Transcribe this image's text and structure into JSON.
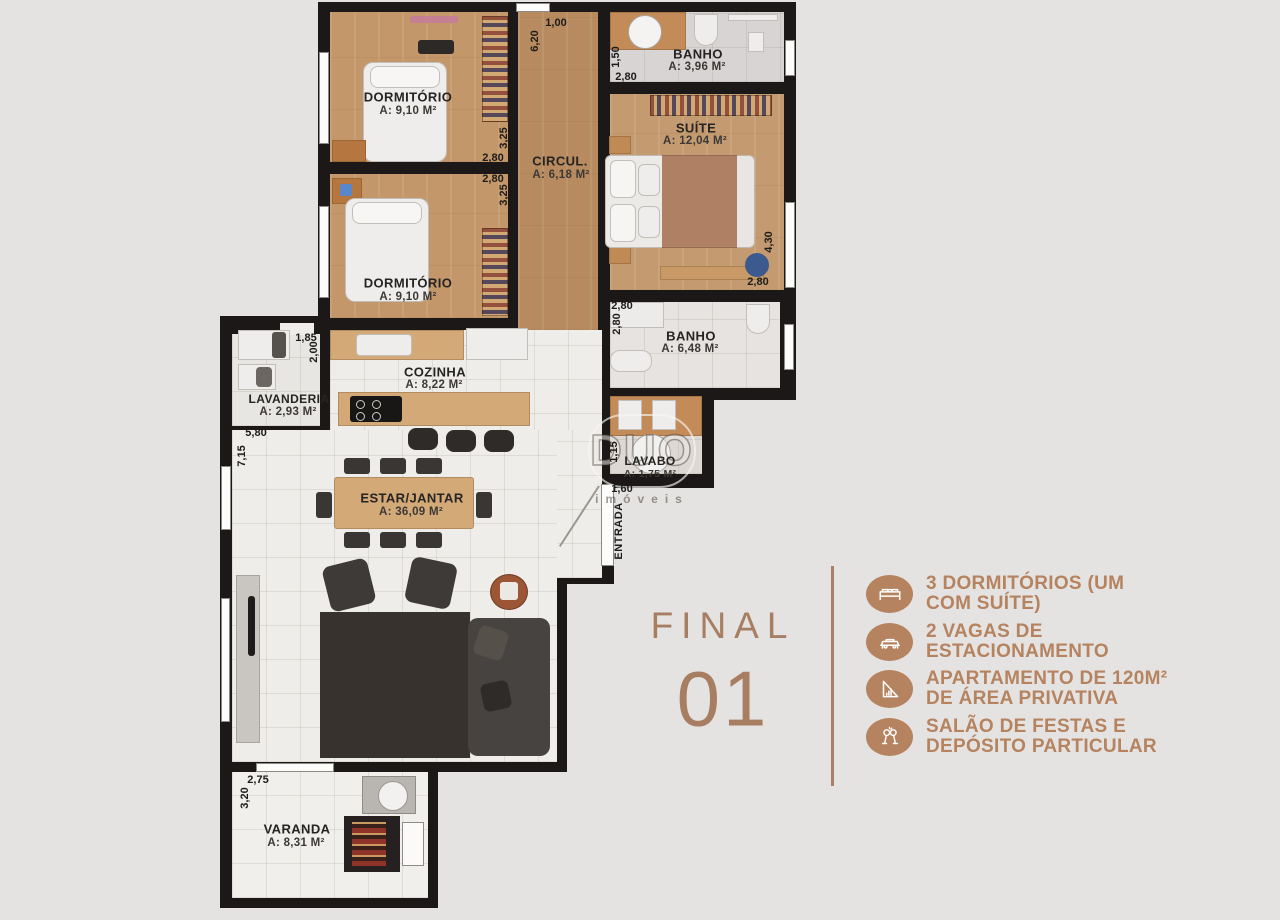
{
  "plan": {
    "rooms": [
      {
        "name": "DORMITÓRIO",
        "area": "A: 9,10 M²"
      },
      {
        "name": "DORMITÓRIO",
        "area": "A: 9,10 M²"
      },
      {
        "name": "CIRCUL.",
        "area": "A: 6,18 M²"
      },
      {
        "name": "BANHO",
        "area": "A: 3,96 M²"
      },
      {
        "name": "SUÍTE",
        "area": "A: 12,04 M²"
      },
      {
        "name": "BANHO",
        "area": "A: 6,48 M²"
      },
      {
        "name": "LAVABO",
        "area": "A: 1,75 M²"
      },
      {
        "name": "COZINHA",
        "area": "A: 8,22 M²"
      },
      {
        "name": "LAVANDERIA",
        "area": "A: 2,93 M²"
      },
      {
        "name": "ESTAR/JANTAR",
        "area": "A: 36,09 M²"
      },
      {
        "name": "VARANDA",
        "area": "A: 8,31 M²"
      }
    ],
    "dimensions": [
      "1,00",
      "6,20",
      "1,50",
      "2,80",
      "2,80",
      "2,80",
      "3,25",
      "3,25",
      "4,30",
      "2,80",
      "2,80",
      "2,80",
      "1,85",
      "2,00",
      "5,80",
      "7,15",
      "1,15",
      "1,60",
      "2,75",
      "3,20"
    ],
    "entrance_label": "ENTRADA",
    "watermark": {
      "line1": "DUO",
      "line2": "imóveis"
    }
  },
  "panel": {
    "title": "FINAL",
    "number": "01",
    "features": [
      {
        "icon": "bed-icon",
        "line1": "3 DORMITÓRIOS (UM",
        "line2": "COM SUÍTE)"
      },
      {
        "icon": "car-icon",
        "line1": "2 VAGAS DE",
        "line2": "ESTACIONAMENTO"
      },
      {
        "icon": "set-square-icon",
        "line1": "APARTAMENTO DE 120M²",
        "line2": "DE ÁREA PRIVATIVA"
      },
      {
        "icon": "toast-icon",
        "line1": "SALÃO DE FESTAS E",
        "line2": "DEPÓSITO PARTICULAR"
      }
    ]
  },
  "colors": {
    "background": "#e5e3e1",
    "wall": "#1b1817",
    "wood_floor": "#c39769",
    "accent": "#ab8066",
    "feature_text": "#b5835f"
  }
}
